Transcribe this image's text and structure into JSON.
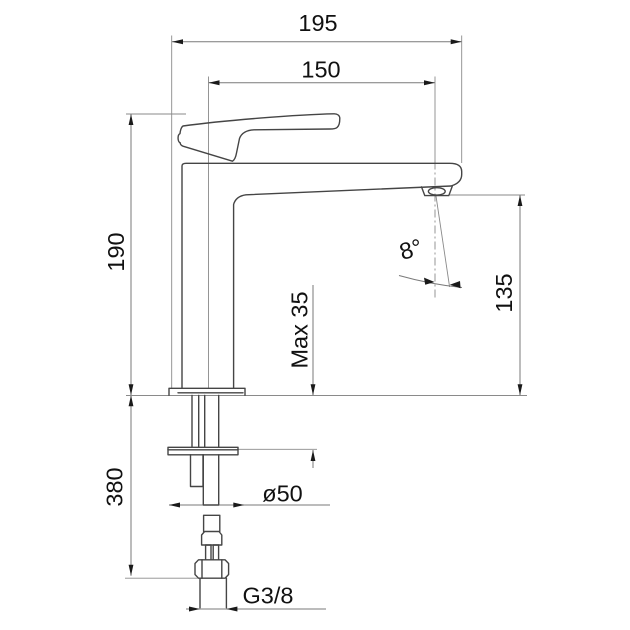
{
  "drawing": {
    "subject": "basin mixer faucet technical dimension drawing, side view",
    "dimensions": {
      "overall_width": "195",
      "spout_reach": "150",
      "body_height": "190",
      "outlet_height": "135",
      "spout_angle": "8°",
      "max_deck_thickness": "Max 35",
      "hose_length": "380",
      "base_diameter": "ø50",
      "thread": "G3/8"
    },
    "colors": {
      "background": "#ffffff",
      "outline": "#454545",
      "dimension_lines": "#7a7a7a",
      "text": "#111111"
    }
  }
}
